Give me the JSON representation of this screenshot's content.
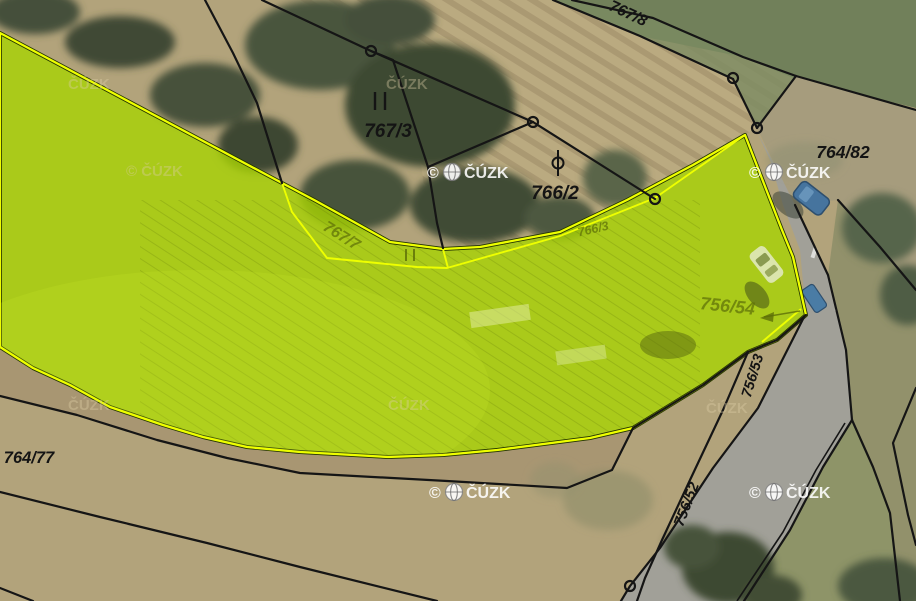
{
  "app": {
    "view": "cadastral-map-orthophoto"
  },
  "colors": {
    "selection-fill": "#a7d302",
    "selection-outline": "#eeff00",
    "boundary-color": "#151515",
    "label-color": "#141414",
    "olive-label-color": "#5d6e08"
  },
  "watermarks": {
    "symbol": "©",
    "name": "ČÚZK",
    "full": "© ČÚZK"
  },
  "parcel_labels": [
    {
      "id": "767-8",
      "text": "767/8"
    },
    {
      "id": "767-3",
      "text": "767/3"
    },
    {
      "id": "766-2",
      "text": "766/2"
    },
    {
      "id": "764-82",
      "text": "764/82"
    },
    {
      "id": "764-77",
      "text": "764/77"
    },
    {
      "id": "756-53",
      "text": "756/53"
    },
    {
      "id": "756-52",
      "text": "756/52"
    },
    {
      "id": "767-7",
      "text": "767/7"
    },
    {
      "id": "766-3",
      "text": "766/3"
    },
    {
      "id": "756-54",
      "text": "756/54"
    }
  ]
}
